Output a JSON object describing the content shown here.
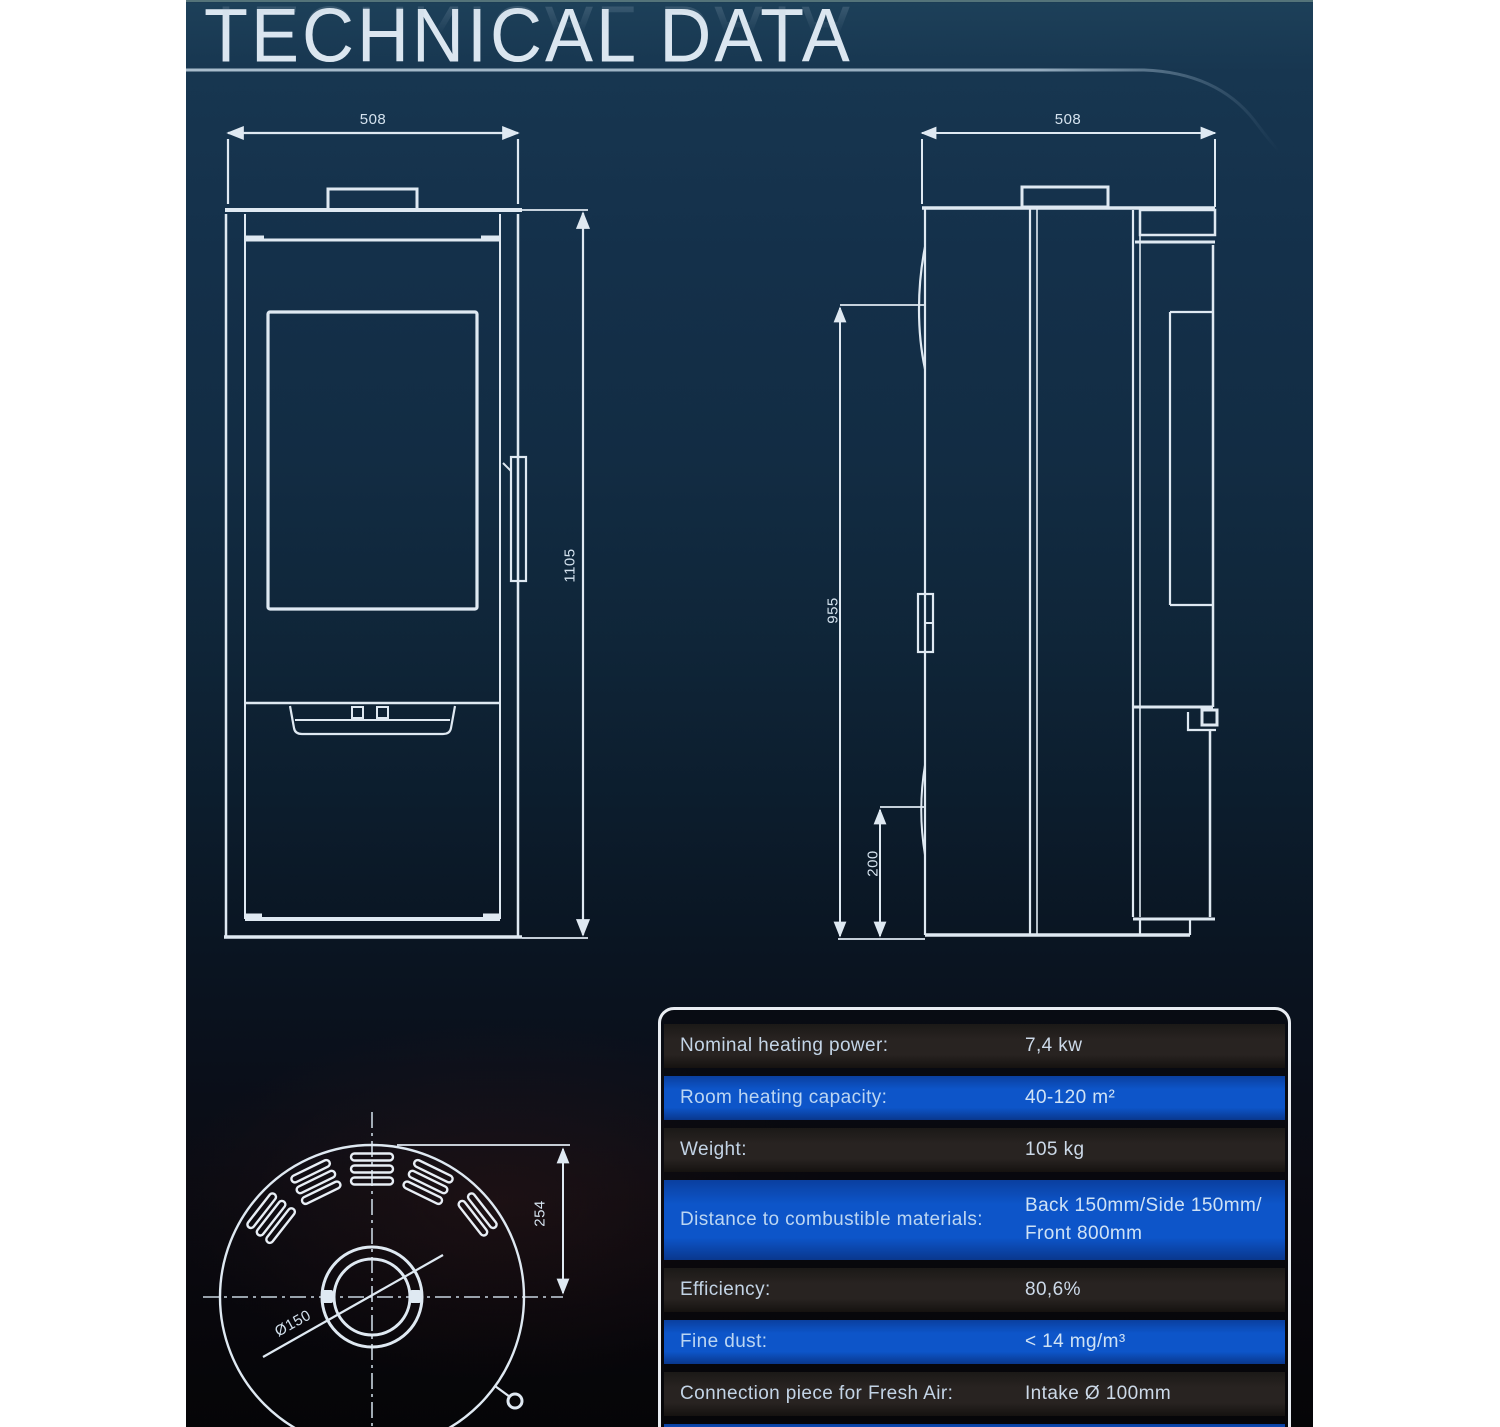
{
  "title": {
    "text": "TECHNICAL DATA"
  },
  "front_view": {
    "width_mm": "508",
    "height_mm": "1105"
  },
  "side_view": {
    "depth_mm": "508",
    "height_mm": "955",
    "clearance_mm": "200"
  },
  "bottom_view": {
    "offset_mm": "254",
    "flue_diameter": "Ø150"
  },
  "spec_table": {
    "rows": [
      {
        "label": "Nominal heating power:",
        "value": "7,4 kw"
      },
      {
        "label": "Room heating capacity:",
        "value": "40-120 m²"
      },
      {
        "label": "Weight:",
        "value": "105 kg"
      },
      {
        "label": "Distance to combustible materials:",
        "value": "Back 150mm/Side 150mm/\nFront 800mm"
      },
      {
        "label": "Efficiency:",
        "value": "80,6%"
      },
      {
        "label": "Fine dust:",
        "value": "< 14 mg/m³"
      },
      {
        "label": "Connection piece for Fresh Air:",
        "value": "Intake Ø 100mm"
      }
    ]
  },
  "colors": {
    "accent_blue": "#0d55c9",
    "row_dark": "#24201d",
    "drawing_line": "#dfe9f2",
    "panel_top": "#173650",
    "panel_bottom": "#050507"
  }
}
